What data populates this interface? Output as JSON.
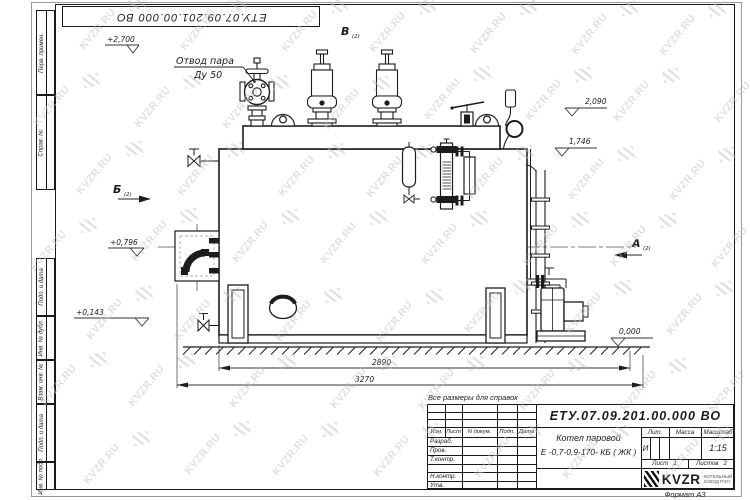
{
  "doc": {
    "number": "ЕТУ.07.09.201.00.000  ВО",
    "note": "Все размеры для справок",
    "format_label": "Формат  А3",
    "name_line1": "Котел паровой",
    "name_line2": "Е -0,7-0,9-170- КБ ( ЖК )"
  },
  "watermark": {
    "text": "KVZR.RU"
  },
  "frame_stamps": {
    "top_box": "ЕТУ.07.09.201.00.000  ВО",
    "left_top": [
      "Перв. примен.",
      "Справ. №"
    ],
    "left_bottom": [
      "Подп. и дата",
      "Инв. № дубл.",
      "Взам. инв. №",
      "Подп. и дата",
      "Инв. № подл."
    ]
  },
  "titleblock": {
    "header_cols": [
      "Изм.",
      "Лист",
      "N докум.",
      "Подп.",
      "Дата"
    ],
    "signoff_rows": [
      "Разраб.",
      "Пров.",
      "Т.контр.",
      "",
      "Н.контр.",
      "Утв."
    ],
    "lit_label": "Лит.",
    "lit_value": "И",
    "mass_label": "Масса",
    "scale_label": "Масштаб",
    "scale_value": "1:15",
    "sheet_label": "Лист",
    "sheet_value": "1",
    "sheets_label": "Листов",
    "sheets_value": "2",
    "company": "KVZR",
    "company_sub1": "КОТЕЛЬНЫЙ",
    "company_sub2": "ЗАВОД РЭП"
  },
  "drawing": {
    "labels": {
      "steam_outlet_1": "Отвод пара",
      "steam_outlet_2": "Ду 50",
      "view_v": "В",
      "view_b": "Б",
      "view_a": "А",
      "view_ref": "(2)"
    },
    "levels": {
      "p2700": "+2,700",
      "p2090": "2,090",
      "p1746": "1,746",
      "p0796": "+0,796",
      "p0143": "+0,143",
      "p0000": "0,000"
    },
    "dims": {
      "length_body": "2890",
      "length_total": "3270"
    }
  }
}
